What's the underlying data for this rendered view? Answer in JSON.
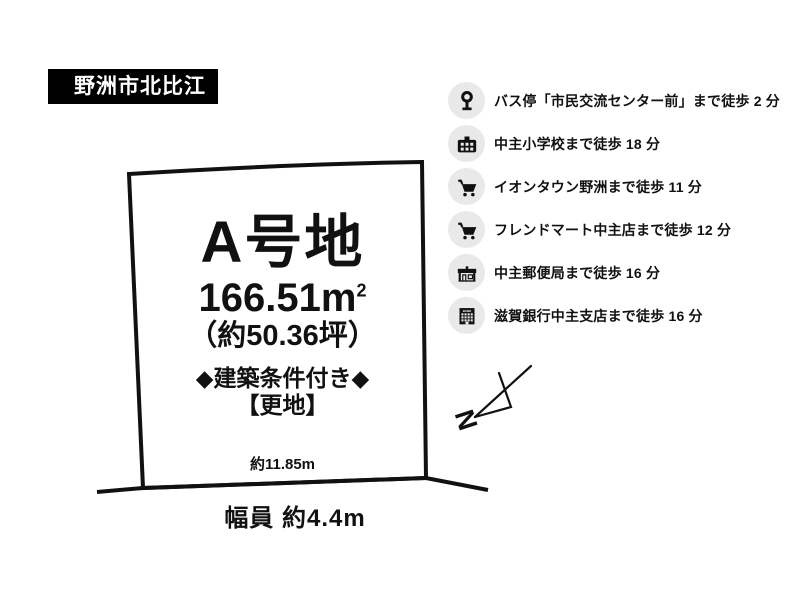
{
  "location_label": "野洲市北比江",
  "plot": {
    "name": "A号地",
    "area_m2": "166.51m",
    "area_sup": "2",
    "area_tsubo": "（約50.36坪）",
    "condition": "◆建築条件付き◆",
    "state": "【更地】",
    "top_dimension": "約11.85m",
    "road_width": "幅員 約4.4m"
  },
  "amenities": [
    {
      "icon": "bus-stop",
      "text": "バス停「市民交流センター前」まで徒歩 2 分"
    },
    {
      "icon": "school",
      "text": "中主小学校まで徒歩 18 分"
    },
    {
      "icon": "cart",
      "text": "イオンタウン野洲まで徒歩 11 分"
    },
    {
      "icon": "cart",
      "text": "フレンドマート中主店まで徒歩 12 分"
    },
    {
      "icon": "post-office",
      "text": "中主郵便局まで徒歩 16 分"
    },
    {
      "icon": "bank",
      "text": "滋賀銀行中主支店まで徒歩 16 分"
    }
  ],
  "compass": {
    "label": "N"
  },
  "colors": {
    "ink": "#111111",
    "label_bg": "#000000",
    "label_fg": "#ffffff",
    "icon_circle_bg": "#e9e9e9",
    "background": "#ffffff"
  }
}
